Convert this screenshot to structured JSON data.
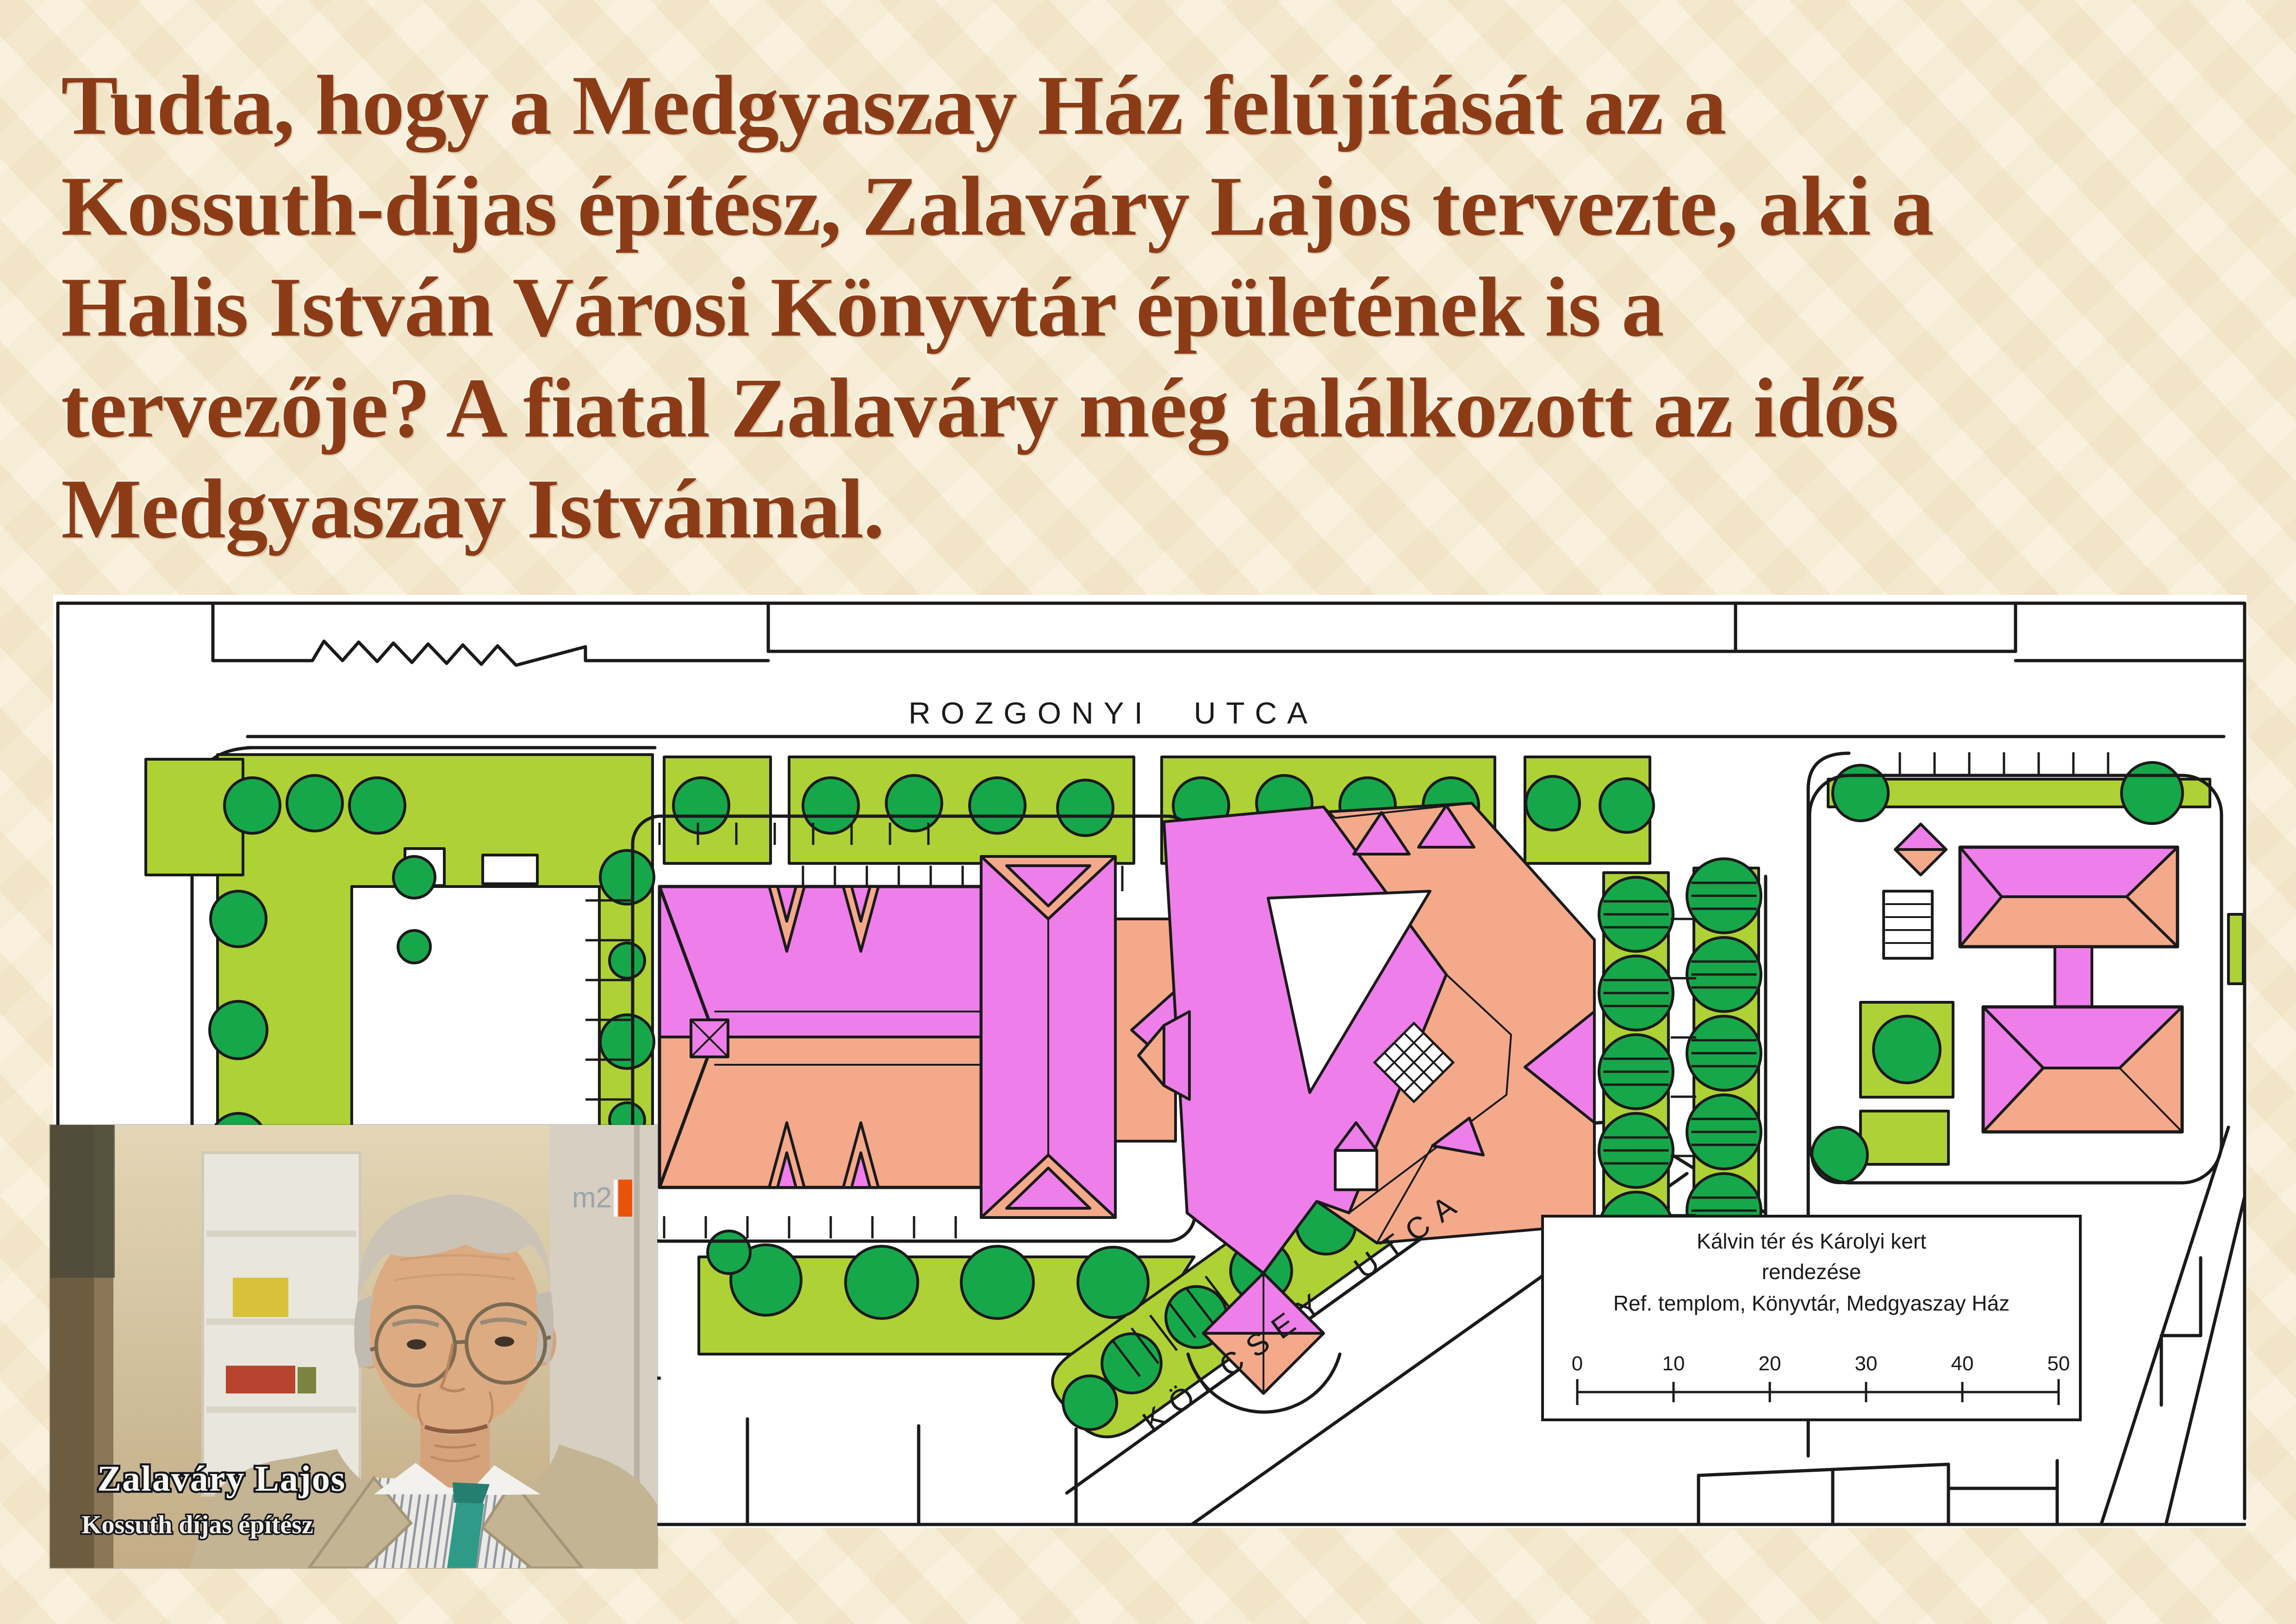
{
  "slide": {
    "background": "#f6ecd3",
    "title_color": "#8b3c16",
    "title_lines": [
      "Tudta, hogy a Medgyaszay Ház felújítását az a",
      "Kossuth-díjas építész, Zalaváry Lajos tervezte, aki a",
      "Halis István Városi Könyvtár épületének is a",
      "tervezője? A fiatal Zalaváry még találkozott az idős",
      "Medgyaszay Istvánnal."
    ]
  },
  "map": {
    "rozgonyi_label": "ROZGONYI  UTCA",
    "kolcsey_label": "KÖLCSEY  UTCA",
    "legend": {
      "line1": "Kálvin tér és Károlyi kert",
      "line2": "rendezése",
      "line3": "Ref. templom, Könyvtár, Medgyaszay Ház"
    },
    "scale_ticks": [
      "0",
      "10",
      "20",
      "30",
      "40",
      "50"
    ],
    "colors": {
      "lawn": "#aed135",
      "tree": "#17a74b",
      "roof_violet": "#ee7ee9",
      "roof_salmon": "#f4a98a",
      "line": "#1a1a1a",
      "paper": "#ffffff"
    }
  },
  "photo": {
    "caption_line1": "Zalaváry Lajos",
    "caption_line2": "Kossuth díjas építész",
    "logo_text": "m2",
    "logo_accent": "#e8540a"
  }
}
